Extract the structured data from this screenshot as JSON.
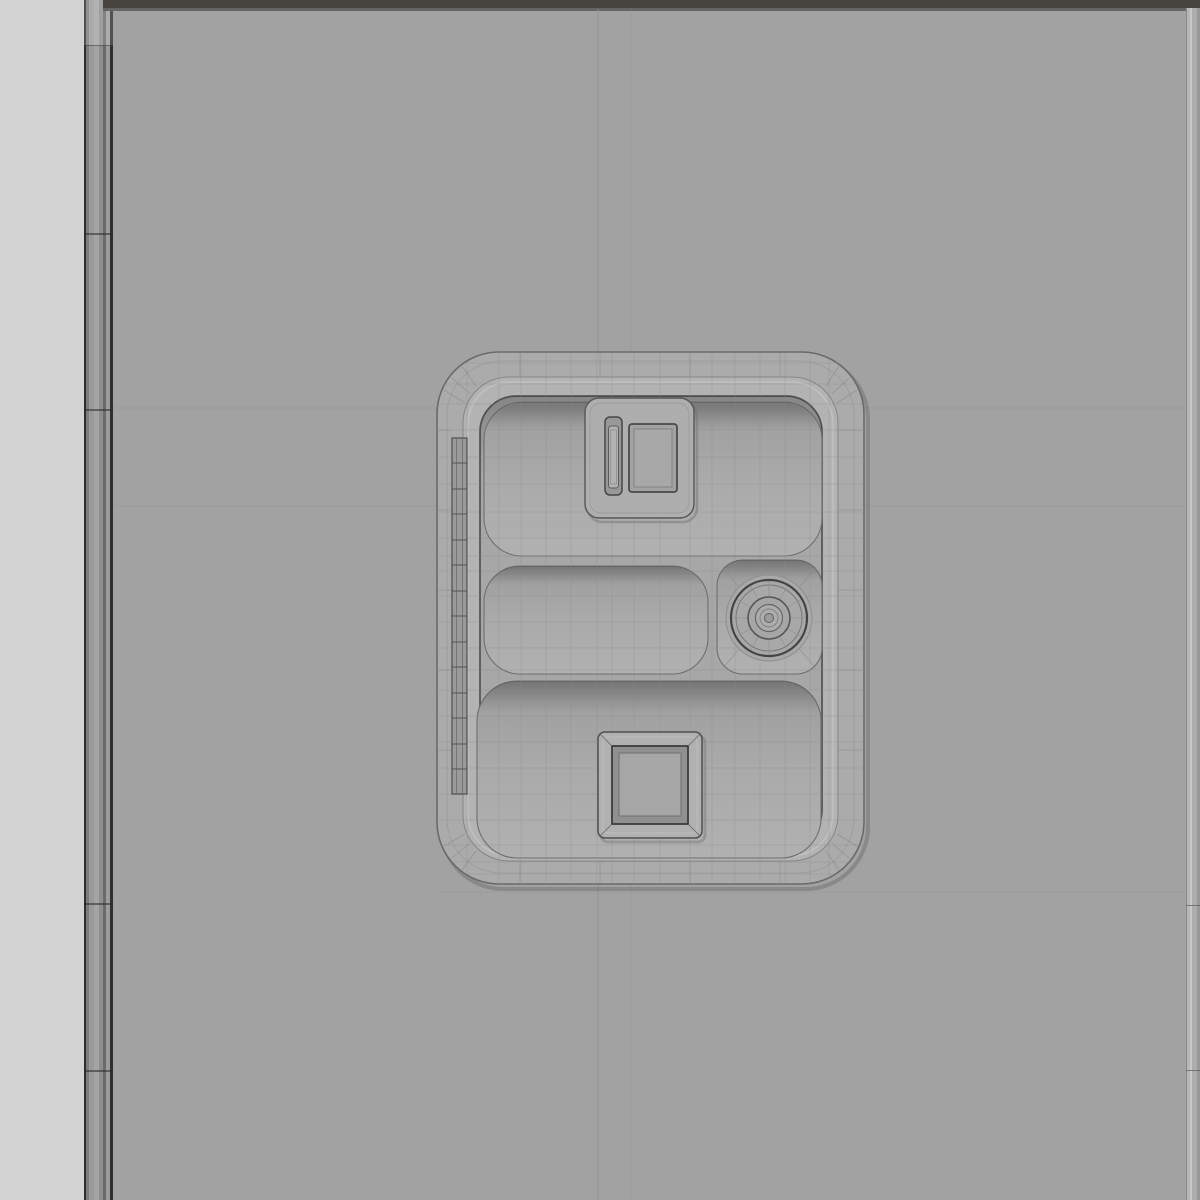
{
  "colors": {
    "viewport_bg": "#a2a2a2",
    "left_strip": "#d3d3d3",
    "left_band_dark": "#2f2f2f",
    "top_bar": "#47443f",
    "right_band": "#b6b6b6",
    "object_base": "#ababab",
    "rim_fill": "#b3b3b3",
    "interior_fill": "#a7a7a7",
    "pocket_top_shade": "#919191",
    "pocket_bottom": "#b1b1b1",
    "plane_line": "#8f8f8f",
    "wire": "#8a8a8a",
    "edge_dark": "#6a6a6a",
    "feature_outline": "#434343"
  },
  "scene": {
    "object": "overhead-console-panel-wireframe",
    "visible_features": [
      "outer-rounded-panel",
      "raised-rim",
      "top-pocket",
      "middle-pocket",
      "knob-recess",
      "bottom-pocket",
      "slider-switch-housing",
      "rotary-knob",
      "square-push-button",
      "hinge-strip"
    ],
    "hinge_segment_count": 13,
    "knob_spoke_count": 12,
    "knob_ring_count": 5
  }
}
